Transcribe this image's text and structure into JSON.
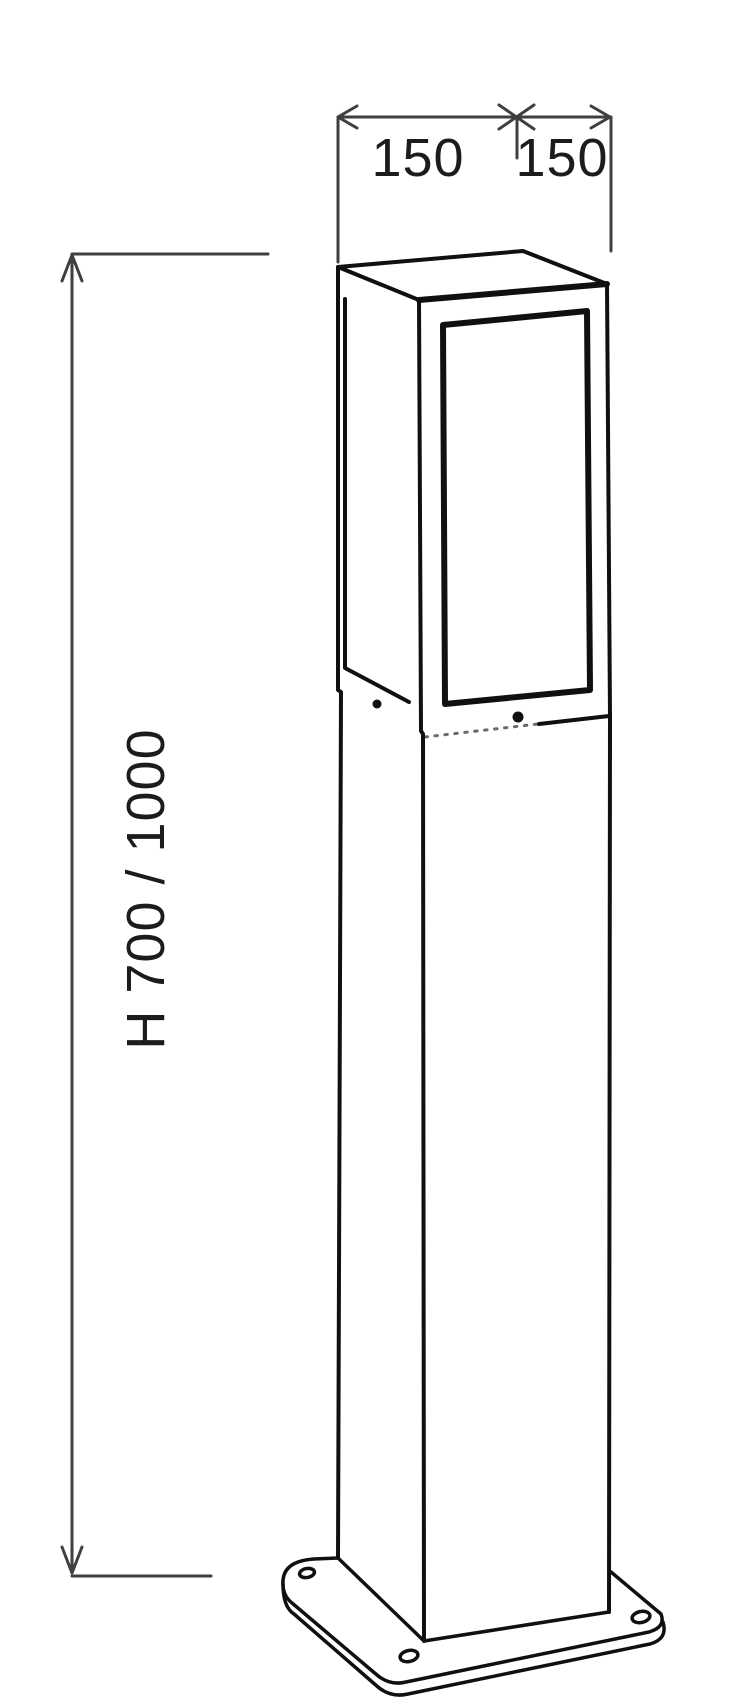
{
  "colors": {
    "background": "#ffffff",
    "outline": "#101010",
    "dimension": "#3f3f3f",
    "label": "#1c1c1c",
    "seam": "#6a6a6a"
  },
  "dimensions": {
    "top_width_left": "150",
    "top_width_right": "150",
    "height": "H 700 / 1000"
  }
}
